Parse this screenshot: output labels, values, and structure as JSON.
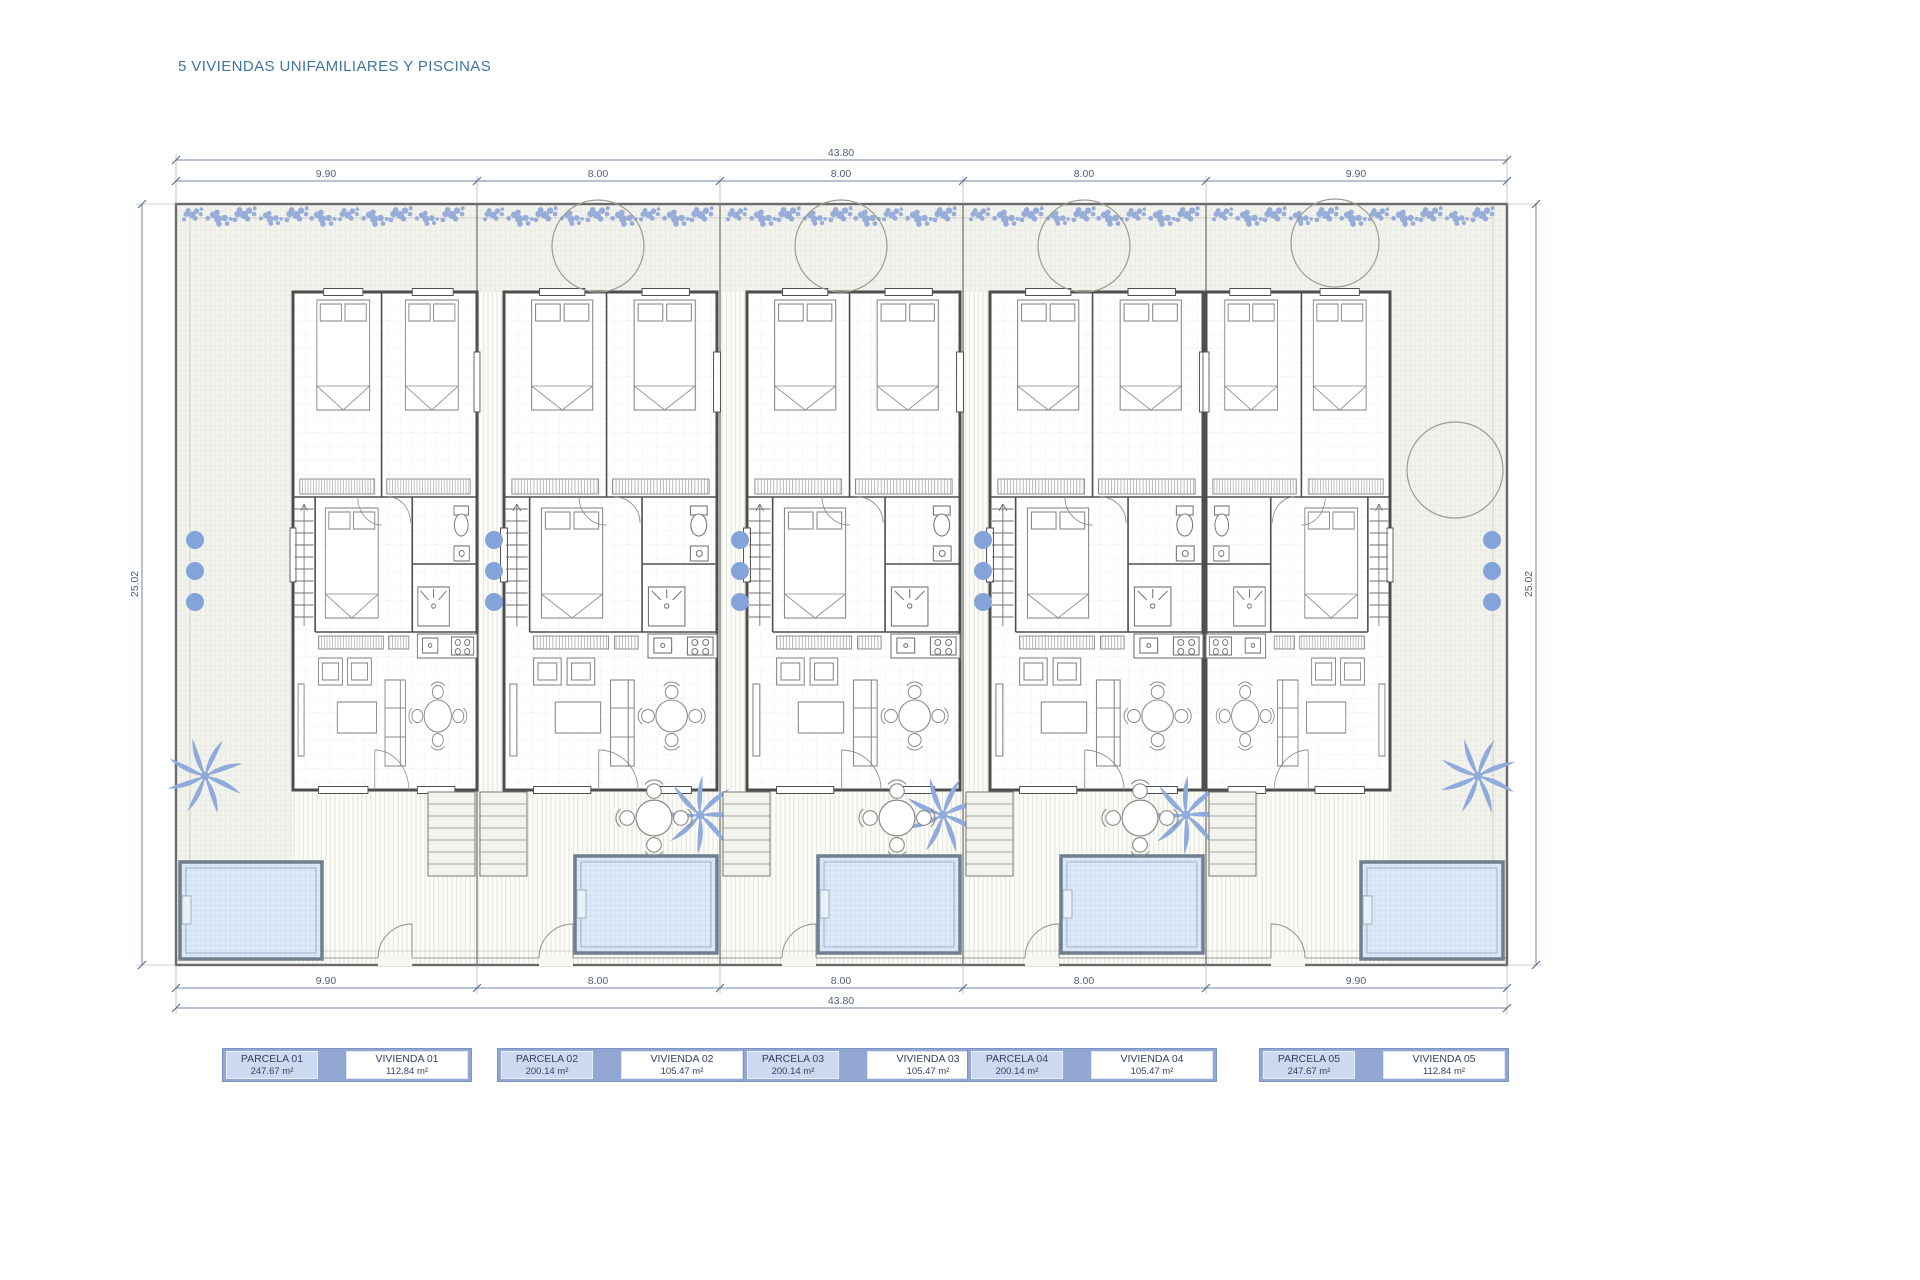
{
  "title": "5 VIVIENDAS UNIFAMILIARES Y PISCINAS",
  "dimensions": {
    "top_total": "43.80",
    "bottom_total": "43.80",
    "top_segments": [
      "9.90",
      "8.00",
      "8.00",
      "8.00",
      "9.90"
    ],
    "bottom_segments": [
      "9.90",
      "8.00",
      "8.00",
      "8.00",
      "9.90"
    ],
    "left_side": "25.02",
    "right_side": "25.02"
  },
  "parcels": [
    {
      "parcela": "PARCELA 01",
      "parcela_area": "247.67 m²",
      "vivienda": "VIVIENDA 01",
      "vivienda_area": "112.84 m²"
    },
    {
      "parcela": "PARCELA 02",
      "parcela_area": "200.14 m²",
      "vivienda": "VIVIENDA 02",
      "vivienda_area": "105.47 m²"
    },
    {
      "parcela": "PARCELA 03",
      "parcela_area": "200.14 m²",
      "vivienda": "VIVIENDA 03",
      "vivienda_area": "105.47 m²"
    },
    {
      "parcela": "PARCELA 04",
      "parcela_area": "200.14 m²",
      "vivienda": "VIVIENDA 04",
      "vivienda_area": "105.47 m²"
    },
    {
      "parcela": "PARCELA 05",
      "parcela_area": "247.67 m²",
      "vivienda": "VIVIENDA 05",
      "vivienda_area": "112.84 m²"
    }
  ],
  "colors": {
    "title_text": "#41759e",
    "dimension_line": "#7386a0",
    "dimension_text": "#51617a",
    "plant_blue": "#8fabdc",
    "pool_fill": "#dce9f7",
    "label_outer": "#93a7d4",
    "label_parcela_bg": "#cbdaf0",
    "label_vivienda_bg": "#ffffff",
    "label_text": "#35425f"
  }
}
